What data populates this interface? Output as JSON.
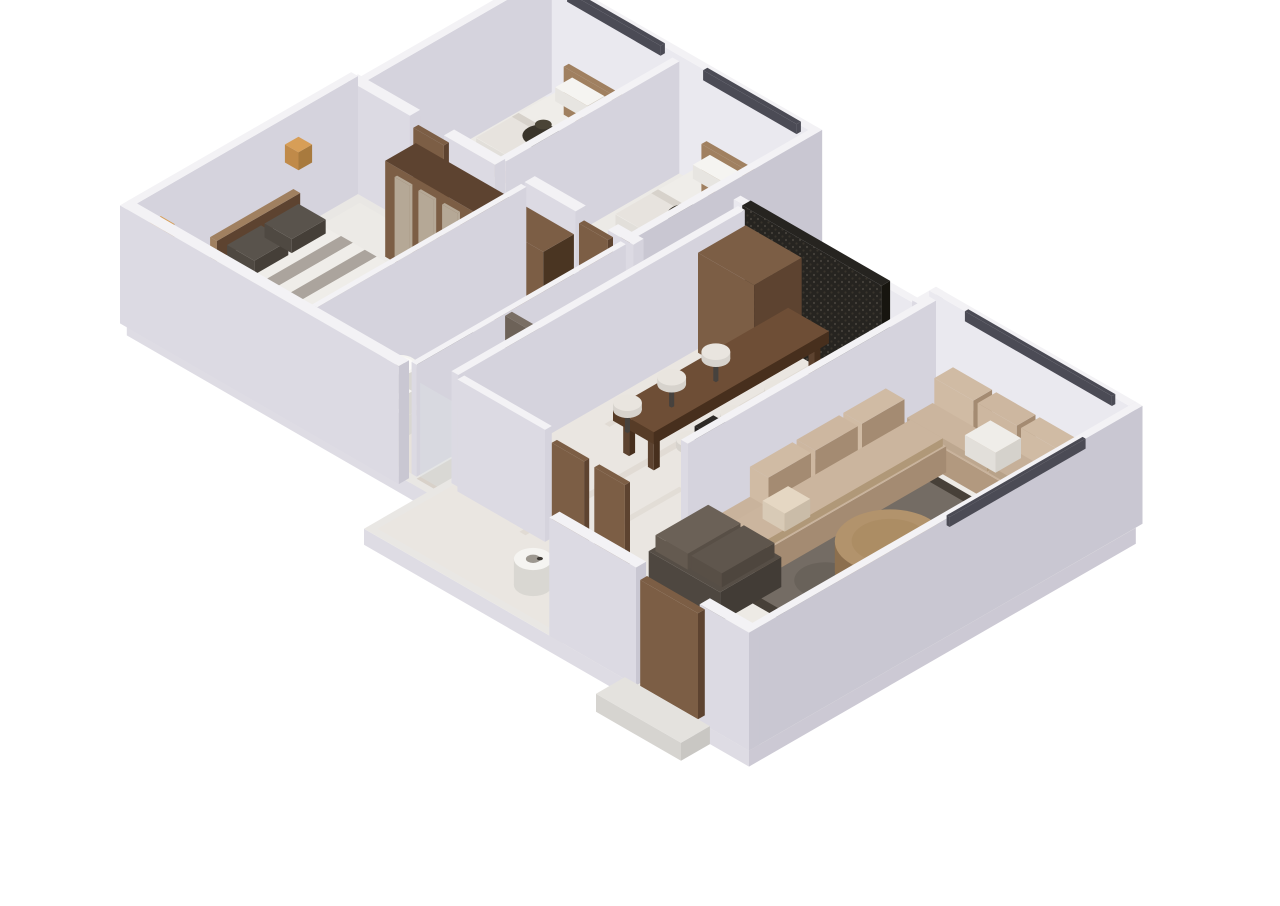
{
  "scene": {
    "type": "isometric-3d-floor-plan",
    "description": "3D isometric render of an apartment floor plan on a white background",
    "rooms": [
      {
        "id": "bedroom-1",
        "furniture": [
          "double-bed",
          "pillows",
          "dark-plant-decor",
          "nightstand",
          "window-rail"
        ]
      },
      {
        "id": "bedroom-2",
        "furniture": [
          "double-bed",
          "pillows",
          "dark-plant-decor",
          "foot-bench",
          "window-rail"
        ]
      },
      {
        "id": "master-bedroom",
        "furniture": [
          "double-bed",
          "dark-pillows",
          "striped-blanket",
          "striped-rug",
          "wardrobe-row",
          "stool",
          "wall-lamps"
        ]
      },
      {
        "id": "bathroom",
        "furniture": [
          "pedestal-sink",
          "toilet",
          "shower-cubicle",
          "vanity-desk"
        ]
      },
      {
        "id": "hallway",
        "furniture": [
          "wood-doors",
          "white-round-object",
          "marble-floor"
        ]
      },
      {
        "id": "kitchen-dining",
        "furniture": [
          "dining-bar-counter",
          "bar-chairs",
          "kitchen-counter",
          "cooktop",
          "coffee-machine",
          "tall-cabinet",
          "slatted-feature-wall"
        ]
      },
      {
        "id": "living-room",
        "furniture": [
          "u-shaped-sofa",
          "area-rug",
          "round-ottoman",
          "scatter-cushions",
          "window-rail",
          "entrance-door",
          "entrance-step"
        ]
      }
    ]
  },
  "palette": {
    "bg": "#ffffff",
    "wallTop": "#f3f2f5",
    "wallSW": "#dcdae3",
    "wallSE": "#c9c7d2",
    "wallInner": "#eae9ef",
    "wallShade": "#d5d3dd",
    "slabTop": "#e9e7e4",
    "slabSide": "#dedce4",
    "slabSE": "#ccc9d4",
    "floorBed": "#eceae6",
    "floorBath": "#e7e2db",
    "floorHall": "#e3dcd2",
    "floorKitchen": "#eae6e1",
    "floorLiving": "#edeae5",
    "marbleVein": "#cdc3b6",
    "rail": "#4b4b55",
    "wood": "#7c5e45",
    "woodDark": "#5d4330",
    "woodLight": "#a08060",
    "counterWood": "#6e4e36",
    "counterDark": "#573c27",
    "counterDarker": "#472f1d",
    "counterTop": "#eff0ee",
    "counterSW": "#e6e6e8",
    "counterSE": "#d5d5d9",
    "sofaSeat": "#c9b39c",
    "sofaSW": "#b2997f",
    "sofaSE": "#a48b72",
    "sofaLight": "#d0bba4",
    "sofaDark": "#564e46",
    "rug": "#746c64",
    "rugDark": "#474038",
    "ottoman": "#b2936c",
    "ottomanSide": "#8c6f4e",
    "panel": "#262420",
    "panelSE": "#17150f",
    "shower": "#796e64",
    "showerSW": "#6d6258",
    "showerSE": "#564c43",
    "white": "#f5f4f1",
    "whiteSW": "#e7e5e1",
    "whiteSE": "#d9d7d2",
    "linen": "#efede9",
    "linenSW": "#e2dfda",
    "linenSE": "#d5d2cc",
    "blanket": "#aba49d",
    "pillowDark": "#59534c",
    "bedBase": "#d8d3cc",
    "bedBaseSW": "#c8c3bc",
    "bedBaseSE": "#bab5ae",
    "plant": "#39342a",
    "plantDark": "#232015",
    "lamp": "#d79e57",
    "lampSW": "#c08a49",
    "lampSE": "#a87a3e",
    "chairSeat": "#e9e5df",
    "chairLeg": "#46423e",
    "stove": "#161616",
    "glass": "#dde4e6",
    "mirror": "#b5a896",
    "coffee": "#2e2a26"
  }
}
